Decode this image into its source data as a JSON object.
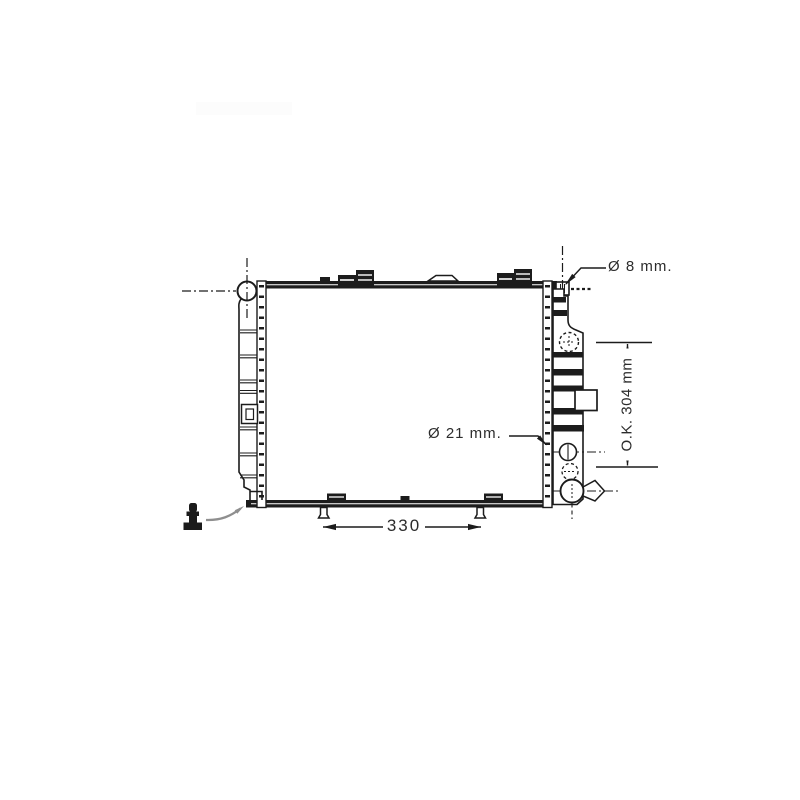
{
  "drawing": {
    "labels": {
      "dia8": "Ø 8 mm.",
      "dia21": "Ø 21 mm.",
      "ok304": "O.K. 304 mm",
      "width330": "330"
    },
    "colors": {
      "line": "#1c1c1c",
      "leader": "#8f8f8f",
      "text": "#2c2c2c",
      "background": "#ffffff"
    }
  }
}
